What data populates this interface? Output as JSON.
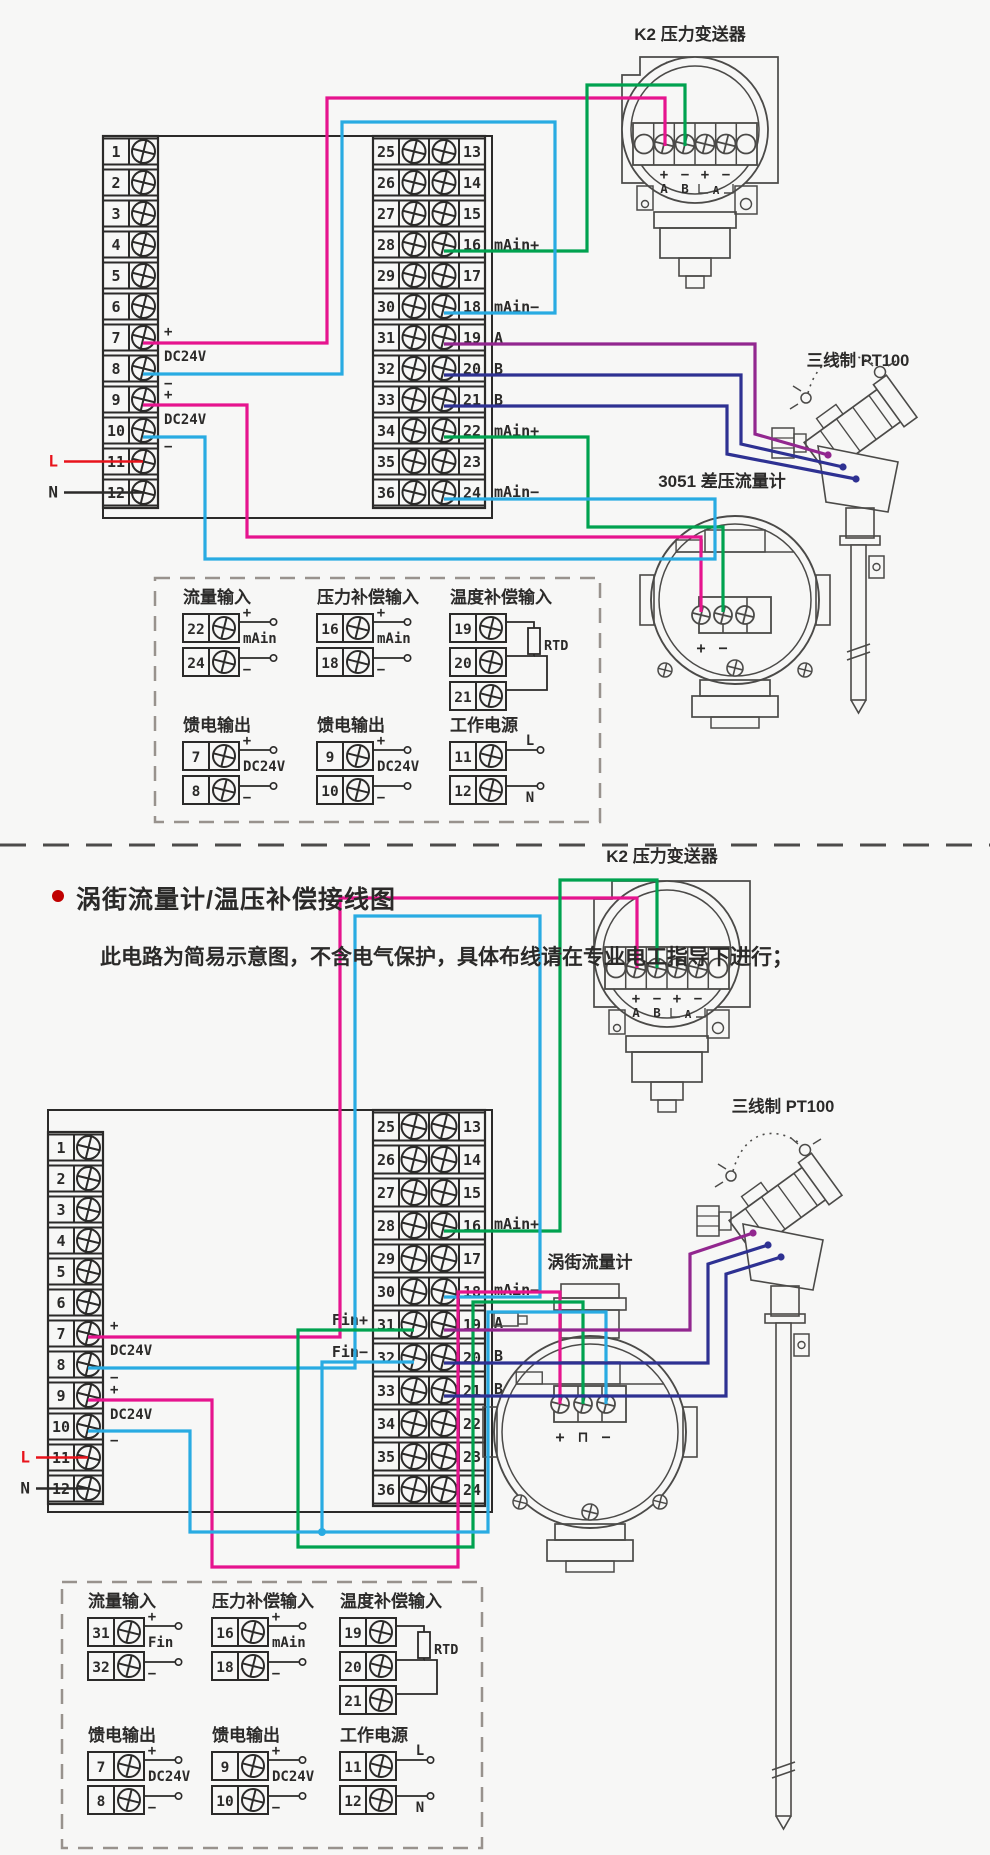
{
  "colors": {
    "background": "#f7f7f6",
    "line_black": "#2b2a29",
    "device_gray": "#4b4a48",
    "dash_gray": "#98928d",
    "wire_magenta": "#e6148e",
    "wire_cyan": "#29abe2",
    "wire_green": "#00a24f",
    "wire_purple": "#92278f",
    "wire_blue": "#2e3192",
    "wire_red": "#e8131b",
    "bullet_red": "#c00000",
    "text": "#2b2a29"
  },
  "section": {
    "title": "涡街流量计/温压补偿接线图",
    "subtitle": "此电路为简易示意图，不含电气保护，具体布线请在专业电工指导下进行；"
  },
  "terminal_blocks": {
    "left_numbers": [
      "1",
      "2",
      "3",
      "4",
      "5",
      "6",
      "7",
      "8",
      "9",
      "10",
      "11",
      "12"
    ],
    "middle_left_numbers": [
      "25",
      "26",
      "27",
      "28",
      "29",
      "30",
      "31",
      "32",
      "33",
      "34",
      "35",
      "36"
    ],
    "middle_right_numbers": [
      "13",
      "14",
      "15",
      "16",
      "17",
      "18",
      "19",
      "20",
      "21",
      "22",
      "23",
      "24"
    ],
    "power_labels": [
      "+",
      "DC24V",
      "−",
      "+",
      "DC24V",
      "−"
    ],
    "line_label": "L",
    "neutral_label": "N"
  },
  "transmitter": {
    "label": "K2 压力变送器",
    "terminal_signs": [
      "+",
      "−",
      "+",
      "−"
    ],
    "port_labels": [
      "A",
      "B"
    ],
    "meter_label": "A"
  },
  "pt100": {
    "label": "三线制 PT100"
  },
  "top_diagram": {
    "flowmeter_label": "3051 差压流量计",
    "flowmeter_terminal_signs": [
      "+",
      "−"
    ],
    "signal_labels": [
      "mAin+",
      "mAin−",
      "A",
      "B",
      "B",
      "mAin+",
      "mAin−"
    ]
  },
  "bottom_diagram": {
    "flowmeter_label": "涡街流量计",
    "flowmeter_terminal_signs": [
      "+",
      "⊓",
      "−"
    ],
    "signal_labels": [
      "mAin+",
      "mAin−",
      "A",
      "B",
      "B"
    ],
    "pulse_plus_label": "Fin+",
    "pulse_minus_label": "Fin−"
  },
  "legend_top": {
    "row1": [
      {
        "title": "流量输入",
        "type": "two",
        "num1": "22",
        "sign1": "+",
        "num2": "24",
        "sign2": "−",
        "mid": "mAin",
        "end_signs": false
      },
      {
        "title": "压力补偿输入",
        "type": "two",
        "num1": "16",
        "sign1": "+",
        "num2": "18",
        "sign2": "−",
        "mid": "mAin",
        "end_signs": false
      },
      {
        "title": "温度补偿输入",
        "type": "rtd",
        "nums": [
          "19",
          "20",
          "21"
        ],
        "mid": "RTD"
      }
    ],
    "row2": [
      {
        "title": "馈电输出",
        "type": "two",
        "num1": "7",
        "sign1": "+",
        "num2": "8",
        "sign2": "−",
        "mid": "DC24V",
        "end_signs": false
      },
      {
        "title": "馈电输出",
        "type": "two",
        "num1": "9",
        "sign1": "+",
        "num2": "10",
        "sign2": "−",
        "mid": "DC24V",
        "end_signs": false
      },
      {
        "title": "工作电源",
        "type": "two",
        "num1": "11",
        "sign1": "L",
        "num2": "12",
        "sign2": "N",
        "mid": "",
        "end_signs": true
      }
    ]
  },
  "legend_bottom": {
    "row1": [
      {
        "title": "流量输入",
        "type": "two",
        "num1": "31",
        "sign1": "+",
        "num2": "32",
        "sign2": "−",
        "mid": "Fin",
        "end_signs": false
      },
      {
        "title": "压力补偿输入",
        "type": "two",
        "num1": "16",
        "sign1": "+",
        "num2": "18",
        "sign2": "−",
        "mid": "mAin",
        "end_signs": false
      },
      {
        "title": "温度补偿输入",
        "type": "rtd",
        "nums": [
          "19",
          "20",
          "21"
        ],
        "mid": "RTD"
      }
    ],
    "row2": [
      {
        "title": "馈电输出",
        "type": "two",
        "num1": "7",
        "sign1": "+",
        "num2": "8",
        "sign2": "−",
        "mid": "DC24V",
        "end_signs": false
      },
      {
        "title": "馈电输出",
        "type": "two",
        "num1": "9",
        "sign1": "+",
        "num2": "10",
        "sign2": "−",
        "mid": "DC24V",
        "end_signs": false
      },
      {
        "title": "工作电源",
        "type": "two",
        "num1": "11",
        "sign1": "L",
        "num2": "12",
        "sign2": "N",
        "mid": "",
        "end_signs": true
      }
    ]
  }
}
